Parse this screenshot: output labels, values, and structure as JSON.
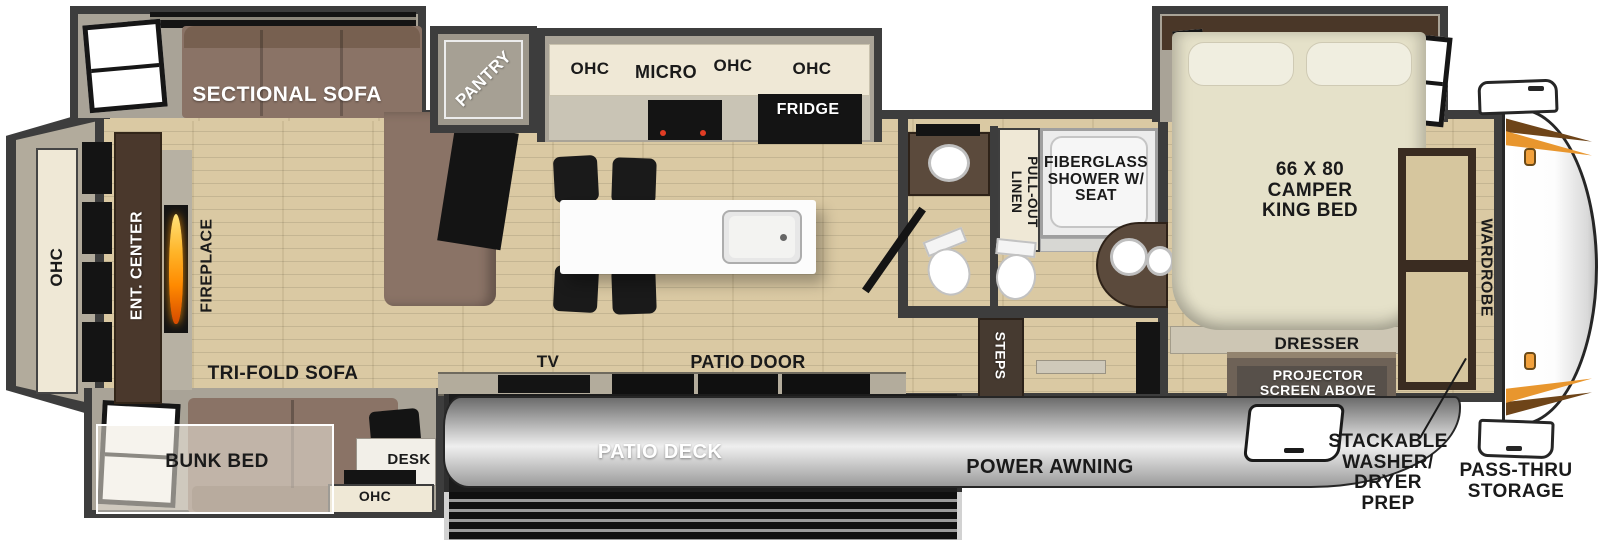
{
  "labels": {
    "sectional_sofa": "SECTIONAL SOFA",
    "pantry": "PANTRY",
    "ohc": "OHC",
    "micro": "MICRO",
    "fridge": "FRIDGE",
    "ent_center": "ENT. CENTER",
    "fireplace": "FIREPLACE",
    "tri_fold_sofa": "TRI-FOLD SOFA",
    "bunk_bed": "BUNK BED",
    "desk": "DESK",
    "tv": "TV",
    "patio_door": "PATIO DOOR",
    "patio_deck": "PATIO DECK",
    "power_awning": "POWER AWNING",
    "pull_out_linen": "PULL-OUT LINEN",
    "fiberglass_shower": "FIBERGLASS SHOWER W/ SEAT",
    "steps": "STEPS",
    "king_bed": "66 X 80 CAMPER KING BED",
    "dresser": "DRESSER",
    "projector_screen": "PROJECTOR SCREEN ABOVE",
    "wardrobe": "WARDROBE",
    "washer_dryer_prep": "STACKABLE WASHER/ DRYER PREP",
    "pass_thru_storage": "PASS-THRU STORAGE"
  },
  "colors": {
    "wall": "#3d3d3d",
    "slide_interior": "#a9a397",
    "floor_wood": "#d8c69e",
    "cabinet_cream": "#efe8d6",
    "sofa_brown": "#8a7366",
    "ent_center_brown": "#4a382c",
    "bed_cream": "#e5e1c9",
    "appliance_black": "#141414",
    "awning_gray": "#c7c7c7",
    "deck_dark": "#1c1c1c",
    "flame_orange": "#ff8a00",
    "front_cap_accent": "#e8962e",
    "label_dark": "#1a1a1a",
    "label_light": "#ffffff"
  }
}
